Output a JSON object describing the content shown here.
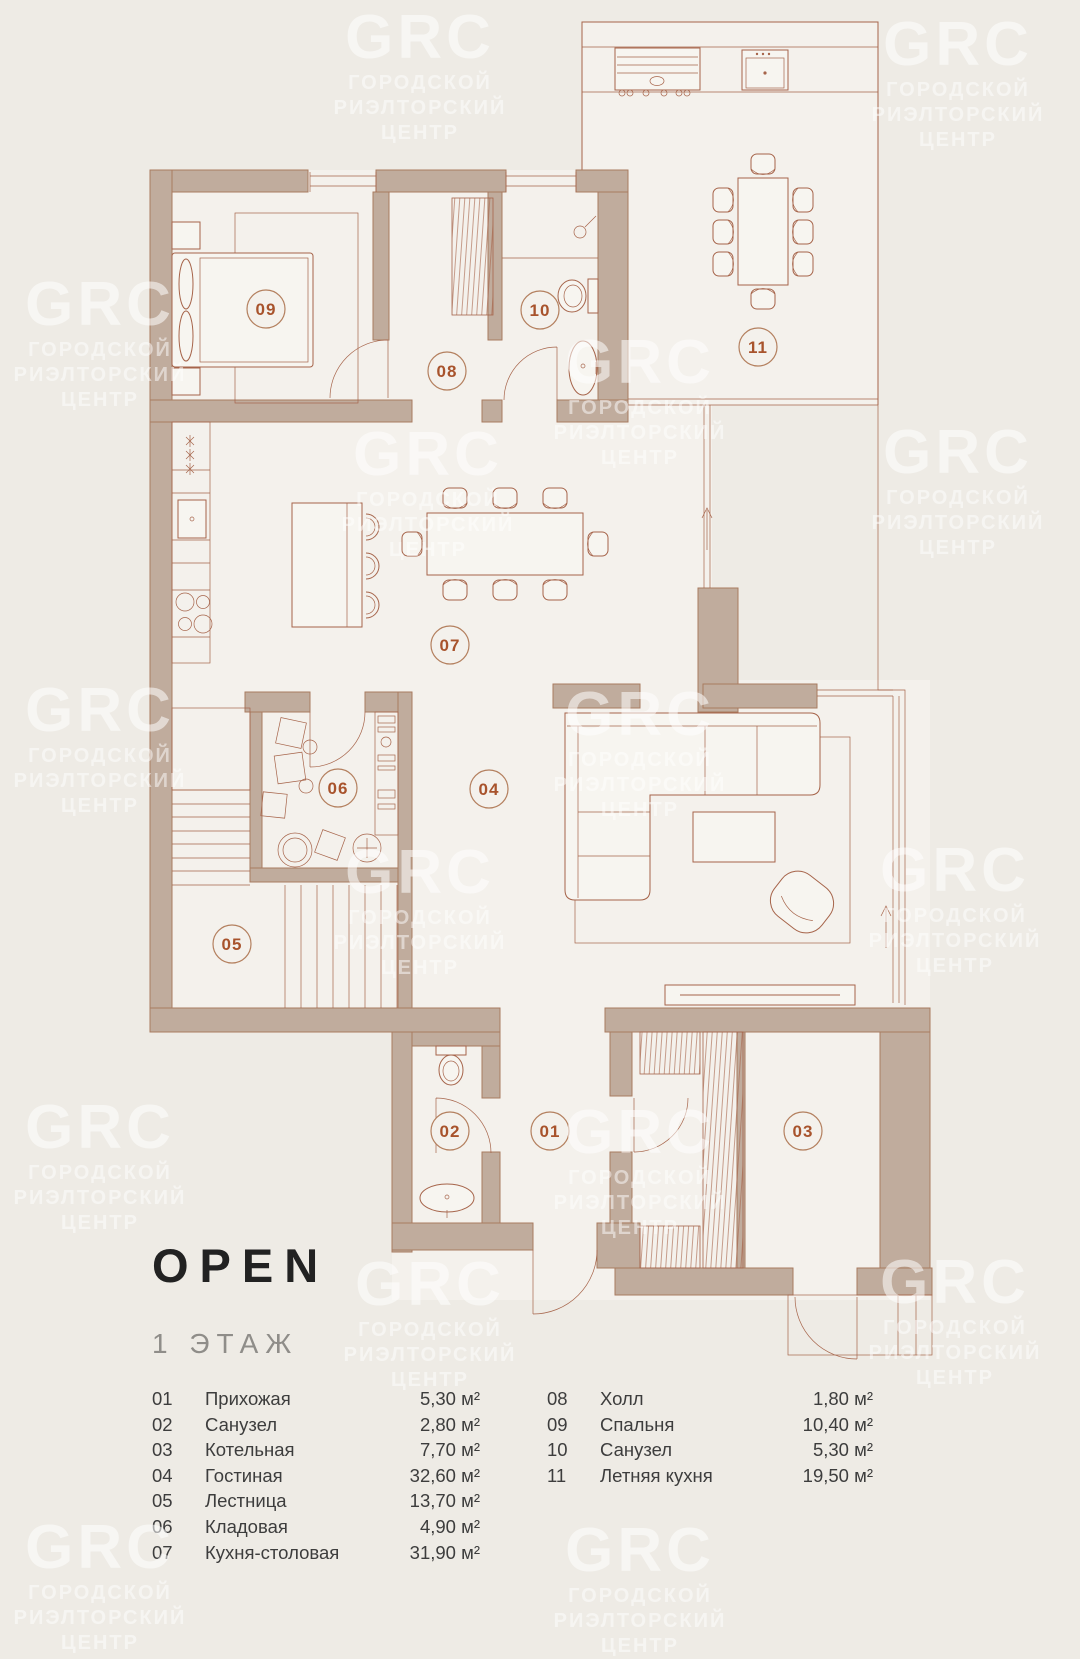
{
  "title": "OPEN",
  "floor": "1 ЭТАЖ",
  "watermark": {
    "logo": "GRC",
    "lines": [
      "ГОРОДСКОЙ",
      "РИЭЛТОРСКИЙ",
      "ЦЕНТР"
    ]
  },
  "plan_labels": {
    "r01": "01",
    "r02": "02",
    "r03": "03",
    "r04": "04",
    "r05": "05",
    "r06": "06",
    "r07": "07",
    "r08": "08",
    "r09": "09",
    "r10": "10",
    "r11": "11"
  },
  "legend": {
    "left": [
      {
        "num": "01",
        "name": "Прихожая",
        "area": "5,30 м²"
      },
      {
        "num": "02",
        "name": "Санузел",
        "area": "2,80 м²"
      },
      {
        "num": "03",
        "name": "Котельная",
        "area": "7,70 м²"
      },
      {
        "num": "04",
        "name": "Гостиная",
        "area": "32,60 м²"
      },
      {
        "num": "05",
        "name": "Лестница",
        "area": "13,70 м²"
      },
      {
        "num": "06",
        "name": "Кладовая",
        "area": "4,90 м²"
      },
      {
        "num": "07",
        "name": "Кухня-столовая",
        "area": "31,90 м²"
      }
    ],
    "right": [
      {
        "num": "08",
        "name": "Холл",
        "area": "1,80 м²"
      },
      {
        "num": "09",
        "name": "Спальня",
        "area": "10,40 м²"
      },
      {
        "num": "10",
        "name": "Санузел",
        "area": "5,30 м²"
      },
      {
        "num": "11",
        "name": "Летняя кухня",
        "area": "19,50 м²"
      }
    ]
  },
  "colors": {
    "background": "#eeebe5",
    "floor": "#f4f1ec",
    "wall": "#c0ac9d",
    "line": "#a6644a",
    "accent_text": "#a8532c",
    "title": "#222222",
    "subtitle": "#8f8d89",
    "legend_text": "#3d3d3d"
  }
}
